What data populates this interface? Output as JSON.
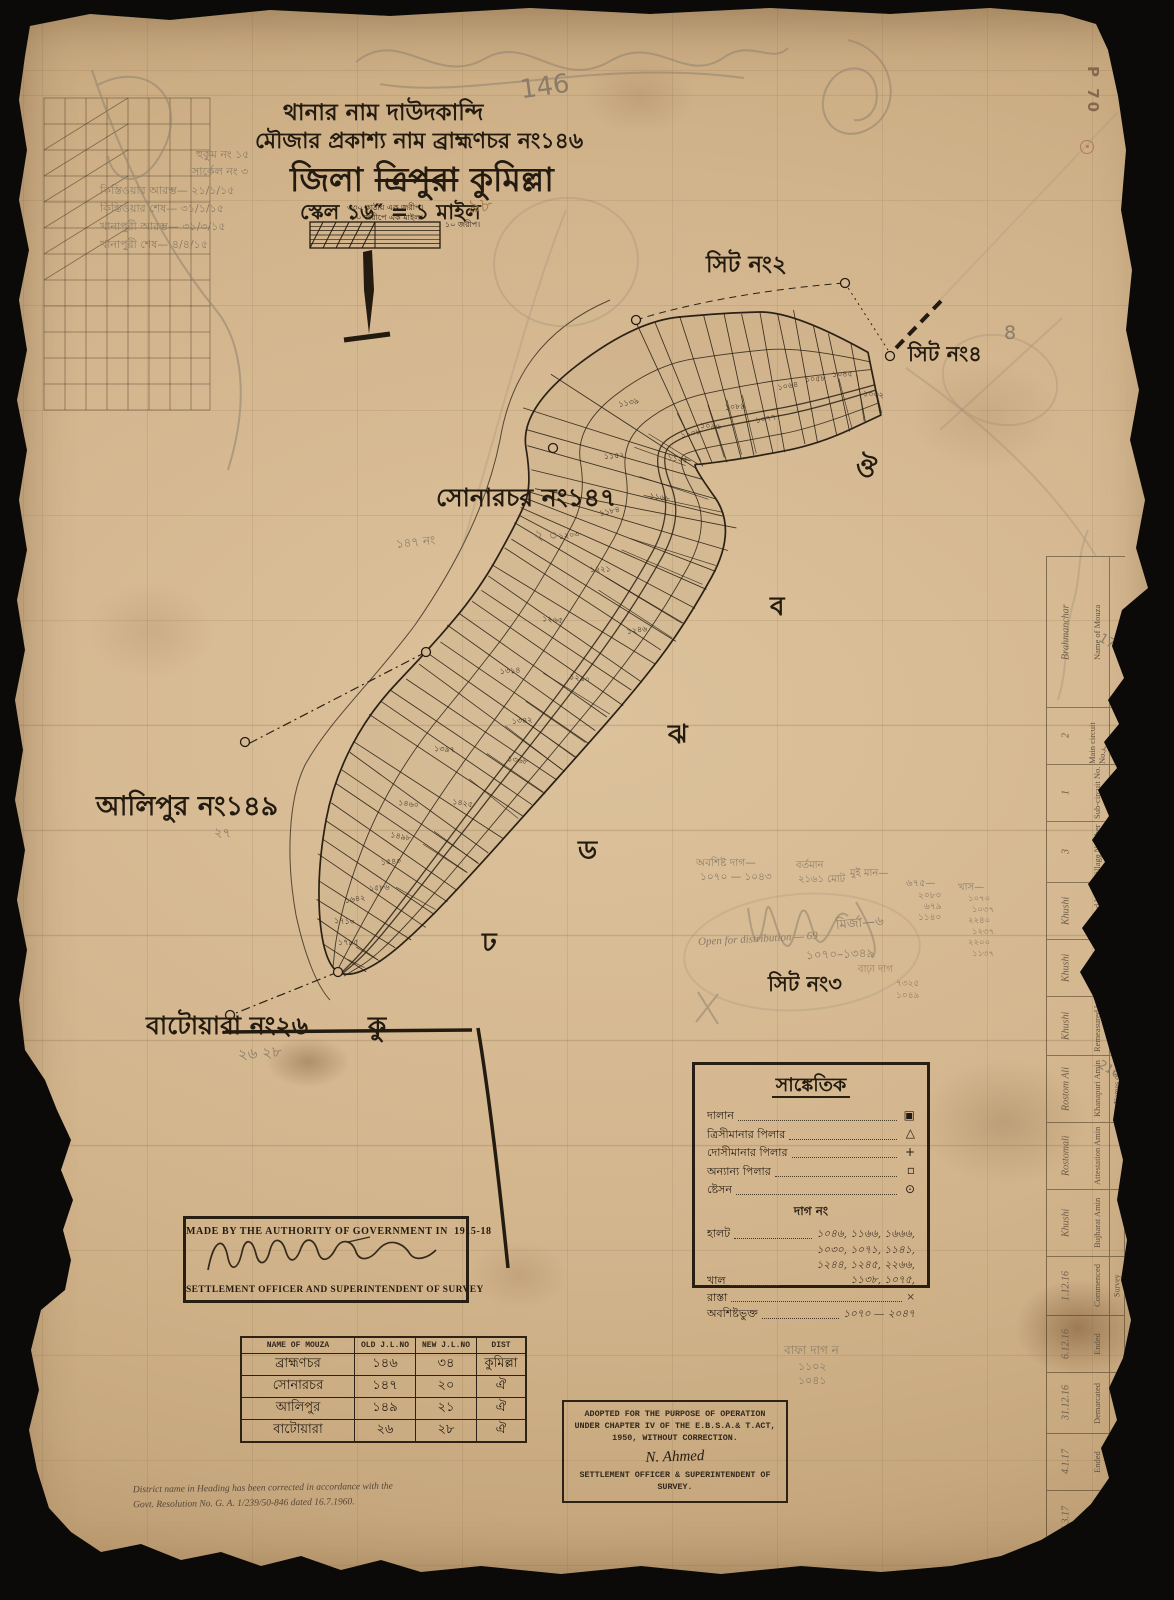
{
  "stamp": {
    "text": "P 70"
  },
  "header": {
    "line1": "থানার নাম দাউদকান্দি",
    "line2": "মৌজার প্রকাশ্য নাম ব্রাহ্মণচর নং১৪৬",
    "line3_prefix": "জিলা",
    "line3_struck": "ত্রিপুরা",
    "line3_suffix": "কুমিল্লা",
    "scale_line": "স্কেল ১৬″ = ১ মাইল",
    "scale_note1": "৩৩০ কাঠায় এক জরীপ।",
    "scale_note2": "৮০ জরীপে এক মাইল।",
    "scale_note3": "১০ জরীপ।"
  },
  "map": {
    "sheet_label_2": "সিট নং২",
    "sheet_label_4": "সিট নং৪",
    "sheet_label_3": "সিট নং৩",
    "neighbor_sonarchar": "সোনারচর নং১৪৭",
    "neighbor_alipur": "আলিপুর নং১৪৯",
    "neighbor_batoyara": "বাটোয়ারা নং২৬",
    "section_letters": [
      {
        "t": "ঔ",
        "x": 856,
        "y": 448
      },
      {
        "t": "ব",
        "x": 770,
        "y": 586
      },
      {
        "t": "ঝ",
        "x": 668,
        "y": 714
      },
      {
        "t": "ড",
        "x": 578,
        "y": 830
      },
      {
        "t": "ঢ",
        "x": 482,
        "y": 922
      },
      {
        "t": "কু",
        "x": 368,
        "y": 1006
      }
    ],
    "plot_numbers": [
      "১০৩২",
      "১০৪৫",
      "১০৫৮",
      "১০৬৪",
      "১০৭৭",
      "১০৮৯",
      "১০৯৬",
      "১১০৮",
      "১১২৫",
      "১১৩৯",
      "১১৫২",
      "১১৬৮",
      "১১৮৪",
      "১২০৩",
      "১২২১",
      "১২৪৬",
      "১২৬৫",
      "১২৯০",
      "১৩১৪",
      "১৩৪২",
      "১৩৬৮",
      "১৩৯৭",
      "১৪২৫",
      "১৪৬০",
      "১৪৯৮",
      "১৫৪০",
      "১৫৮৬",
      "১৬৪২",
      "১৭১০",
      "১৭৯৫"
    ]
  },
  "legend": {
    "title": "সাঙ্কেতিক",
    "symbol_rows": [
      {
        "label": "দালান",
        "symbol": "▣"
      },
      {
        "label": "ত্রিসীমানার পিলার",
        "symbol": "△"
      },
      {
        "label": "দোসীমানার পিলার",
        "symbol": "+"
      },
      {
        "label": "অন্যান্য পিলার",
        "symbol": "▫"
      },
      {
        "label": "ষ্টেসন",
        "symbol": "⊙"
      }
    ],
    "dag_heading": "দাগ নং",
    "entry_rows": [
      {
        "label": "হালট",
        "value": "১০৪৬, ১১৬৬, ১৬৬৬,"
      },
      {
        "label": "খাল",
        "value": "১০৩০, ১০৭১, ১১৪১, ১২৪৪, ১২৪৫, ২২৬৬, ১১৩৮, ১০৭৫,"
      },
      {
        "label": "রাস্তা",
        "value": "×"
      },
      {
        "label": "অবশিষ্টভুক্ত",
        "value": "১০৭০ — ২০৪৭"
      }
    ]
  },
  "authority_box": {
    "line1": "MADE BY THE AUTHORITY OF GOVERNMENT IN",
    "year": "1915-18",
    "line2": "SETTLEMENT OFFICER AND SUPERINTENDENT OF SURVEY"
  },
  "mouza_table": {
    "headers": [
      "NAME OF MOUZA",
      "OLD J.L.NO",
      "NEW J.L.NO",
      "DIST"
    ],
    "rows": [
      [
        "ব্রাহ্মণচর",
        "১৪৬",
        "৩৪",
        "কুমিল্লা"
      ],
      [
        "সোনারচর",
        "১৪৭",
        "২০",
        "ঐ"
      ],
      [
        "আলিপুর",
        "১৪৯",
        "২১",
        "ঐ"
      ],
      [
        "বাটোয়ারা",
        "২৬",
        "২৮",
        "ঐ"
      ]
    ]
  },
  "adopted_box": {
    "line1": "ADOPTED FOR THE PURPOSE OF OPERATION",
    "line2": "UNDER CHAPTER IV OF THE E.B.S.A.& T.ACT,",
    "line3": "1950, WITHOUT CORRECTION.",
    "signature": "N. Ahmed",
    "line4": "SETTLEMENT OFFICER & SUPERINTENDENT OF",
    "line5": "SURVEY."
  },
  "footnote": {
    "line1": "District name in Heading has been corrected in accordance with the",
    "line2": "Govt. Resolution No. G. A. 1/239/50-846 dated 16.7.1960."
  },
  "margin_form": {
    "rows": [
      {
        "label": "Name of Mouza",
        "value": "Brahmanchar",
        "h": 150
      },
      {
        "label": "Main circuit No.",
        "value": "2",
        "h": 56
      },
      {
        "label": "Sub-circuit No.",
        "value": "1",
        "h": 56
      },
      {
        "label": "Village Number",
        "value": "3",
        "h": 60
      },
      {
        "label": "Plotted by",
        "value": "Khushi",
        "h": 56
      },
      {
        "label": "Examined by",
        "value": "Khushi",
        "h": 56
      },
      {
        "label": "Remeasured by",
        "value": "Khushi",
        "h": 58
      },
      {
        "label": "Khanapuri Amin",
        "value": "Rostom Ali",
        "h": 66,
        "group": "Names of"
      },
      {
        "label": "Attestation Amin",
        "value": "Rostomali",
        "h": 66,
        "group": "Names of"
      },
      {
        "label": "Bujharat Amin",
        "value": "Khushi",
        "h": 66,
        "group": "Names of"
      },
      {
        "label": "Commenced",
        "value": "1.12.16",
        "h": 58,
        "group": "Survey"
      },
      {
        "label": "Ended",
        "value": "6.12.16",
        "h": 56,
        "group": "Survey"
      },
      {
        "label": "Demarcated",
        "value": "31.12.16",
        "h": 60,
        "group": "Survey"
      },
      {
        "label": "Ended",
        "value": "4.1.17",
        "h": 56,
        "group": "Survey"
      },
      {
        "label": "Commenced",
        "value": "26.3.17",
        "h": 60,
        "group": "Bujharat"
      },
      {
        "label": "Ended",
        "value": "5.4.17",
        "h": 62,
        "group": "Bujharat"
      }
    ]
  },
  "pencil_notes": [
    {
      "t": "146",
      "x": 520,
      "y": 72,
      "fs": 26,
      "r": -8
    },
    {
      "t": "৯৮",
      "x": 468,
      "y": 192,
      "fs": 19,
      "r": -5,
      "c": "sepia"
    },
    {
      "t": "8",
      "x": 1004,
      "y": 322,
      "fs": 19
    },
    {
      "t": "২ ০",
      "x": 534,
      "y": 524,
      "fs": 15
    },
    {
      "t": "১৪৭ নং",
      "x": 396,
      "y": 534,
      "fs": 12,
      "r": -6
    },
    {
      "t": "২৭",
      "x": 214,
      "y": 824,
      "fs": 13
    },
    {
      "t": "২৬ ২৮",
      "x": 238,
      "y": 1042,
      "fs": 15,
      "r": -4
    },
    {
      "t": "হুকুম নং ১৫",
      "x": 196,
      "y": 146,
      "fs": 11
    },
    {
      "t": "সার্কেল নং ৩",
      "x": 192,
      "y": 163,
      "fs": 11
    },
    {
      "t": "কিস্তিওয়ার আরম্ভ— ২১/১/১৫",
      "x": 100,
      "y": 182,
      "fs": 11
    },
    {
      "t": "কিস্তিওয়ার শেষ— ৩১/১/১৫",
      "x": 100,
      "y": 200,
      "fs": 11
    },
    {
      "t": "খানাপুরী আরম্ভ— ৩১/৩/১৫",
      "x": 100,
      "y": 218,
      "fs": 11
    },
    {
      "t": "খানাপুরী শেষ— ৪/৪/১৫",
      "x": 100,
      "y": 236,
      "fs": 11
    },
    {
      "t": "Open for distribution — 69",
      "x": 698,
      "y": 933,
      "fs": 11,
      "r": -3,
      "it": 1
    },
    {
      "t": "অবশিষ্ট দাগ—",
      "x": 696,
      "y": 856,
      "fs": 10.5
    },
    {
      "t": "১০৭০ — ১০৪৩",
      "x": 700,
      "y": 870,
      "fs": 10.5
    },
    {
      "t": "বর্তমান",
      "x": 796,
      "y": 858,
      "fs": 10
    },
    {
      "t": "২১৬১ মোট",
      "x": 798,
      "y": 872,
      "fs": 10
    },
    {
      "t": "মুই মান—",
      "x": 850,
      "y": 866,
      "fs": 10
    },
    {
      "t": "৬৭৫—",
      "x": 906,
      "y": 876,
      "fs": 10
    },
    {
      "t": "২০৮০",
      "x": 918,
      "y": 888,
      "fs": 9
    },
    {
      "t": "৬৭৯",
      "x": 924,
      "y": 899,
      "fs": 9
    },
    {
      "t": "১১৪০",
      "x": 918,
      "y": 910,
      "fs": 9
    },
    {
      "t": "খাস—",
      "x": 958,
      "y": 880,
      "fs": 10
    },
    {
      "t": "১০৭০",
      "x": 968,
      "y": 892,
      "fs": 8.5
    },
    {
      "t": "১০৩৭",
      "x": 972,
      "y": 903,
      "fs": 8.5
    },
    {
      "t": "২২৪০",
      "x": 968,
      "y": 914,
      "fs": 8.5
    },
    {
      "t": "১২৩৭",
      "x": 972,
      "y": 925,
      "fs": 8.5
    },
    {
      "t": "২২০০",
      "x": 968,
      "y": 936,
      "fs": 8.5
    },
    {
      "t": "১১৩৭",
      "x": 972,
      "y": 947,
      "fs": 8.5
    },
    {
      "t": "মির্জা—৬",
      "x": 836,
      "y": 914,
      "fs": 13,
      "r": -5
    },
    {
      "t": "১০৭০–১৩৪৯",
      "x": 806,
      "y": 946,
      "fs": 12,
      "r": -2
    },
    {
      "t": "বাঢ়া দাগ",
      "x": 858,
      "y": 962,
      "fs": 10,
      "c": "sepia"
    },
    {
      "t": "৭৩২৫",
      "x": 896,
      "y": 976,
      "fs": 9,
      "c": "sepia"
    },
    {
      "t": "১০৪৯",
      "x": 896,
      "y": 988,
      "fs": 9,
      "c": "sepia"
    },
    {
      "t": "বাফা দাগ ন",
      "x": 784,
      "y": 1342,
      "fs": 12
    },
    {
      "t": "১১০২",
      "x": 798,
      "y": 1358,
      "fs": 11
    },
    {
      "t": "১০৪১",
      "x": 798,
      "y": 1372,
      "fs": 11
    },
    {
      "t": "170",
      "x": 1098,
      "y": 636,
      "fs": 13,
      "r": 30
    },
    {
      "t": "180",
      "x": 1100,
      "y": 744,
      "fs": 13,
      "r": 30
    },
    {
      "t": "190",
      "x": 1096,
      "y": 850,
      "fs": 13,
      "r": 30
    },
    {
      "t": "200",
      "x": 1092,
      "y": 950,
      "fs": 12,
      "r": 30
    },
    {
      "t": "216",
      "x": 1098,
      "y": 1062,
      "fs": 12,
      "r": 30
    }
  ]
}
